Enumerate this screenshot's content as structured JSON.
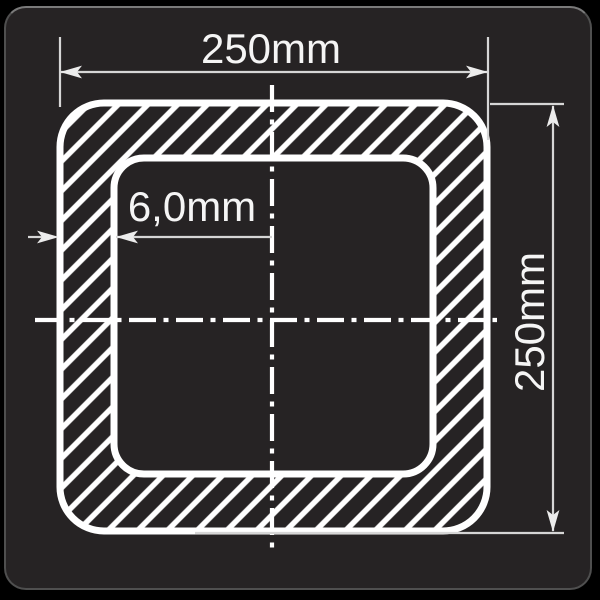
{
  "drawing": {
    "type": "square-hollow-section-cross-section",
    "labels": {
      "width": "250mm",
      "height": "250mm",
      "wall_thickness": "6,0mm"
    }
  },
  "colors": {
    "canvas_background": "#000000",
    "panel_background": "#262324",
    "panel_border": "#4f4f4f",
    "profile_outline": "#ffffff",
    "hatch": "#ffffff",
    "dimension_line": "#d6d6d6",
    "text": "#f5f5f5"
  }
}
